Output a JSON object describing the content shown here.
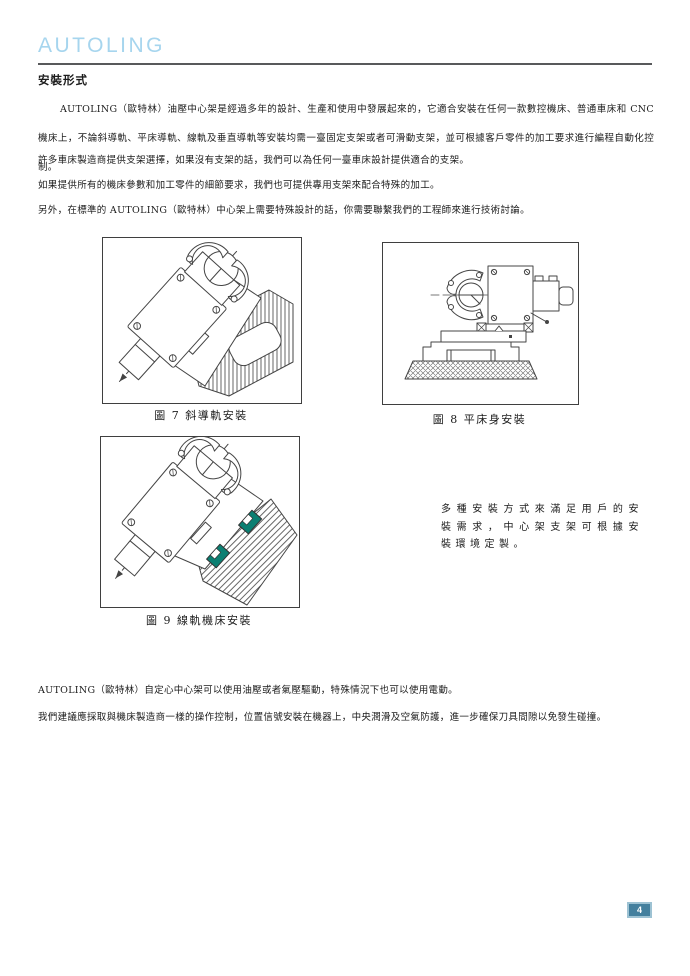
{
  "header": {
    "brand": "AUTOLING",
    "section_title": "安裝形式"
  },
  "content": {
    "p1": "AUTOLING（歐特林）油壓中心架是經過多年的設計、生產和使用中發展起來的，它適合安裝在任何一款數控機床、普通車床和 CNC 機床上，不論斜導軌、平床導軌、線軌及垂直導軌等安裝均需一臺固定支架或者可滑動支架，並可根據客戶零件的加工要求進行編程自動化控制。",
    "p2": "許多車床製造商提供支架選擇，如果沒有支架的話，我們可以為任何一臺車床設計提供適合的支架。",
    "p3": "如果提供所有的機床參數和加工零件的細節要求，我們也可提供專用支架來配合特殊的加工。",
    "p4": "另外，在標準的 AUTOLING（歐特林）中心架上需要特殊設計的話，你需要聯繫我們的工程師來進行技術討論。",
    "side_note": "多種安裝方式來滿足用戶的安裝需求，中心架支架可根據安裝環境定製。",
    "p5": "AUTOLING（歐特林）自定心中心架可以使用油壓或者氣壓驅動，特殊情況下也可以使用電動。",
    "p6": "我們建議應採取與機床製造商一樣的操作控制，位置信號安裝在機器上，中央潤滑及空氣防護，進一步確保刀具間隙以免發生碰撞。"
  },
  "figures": [
    {
      "caption": "圖 7 斜導軌安裝"
    },
    {
      "caption": "圖 8 平床身安裝"
    },
    {
      "caption": "圖 9 線軌機床安裝"
    }
  ],
  "footer": {
    "page_number": "4"
  },
  "colors": {
    "brand_blue": "#a6d5ee",
    "rule_gray": "#58595b",
    "rail_teal": "#0b7f72",
    "badge_bg": "#44809e",
    "badge_border": "#9dc2d3"
  }
}
